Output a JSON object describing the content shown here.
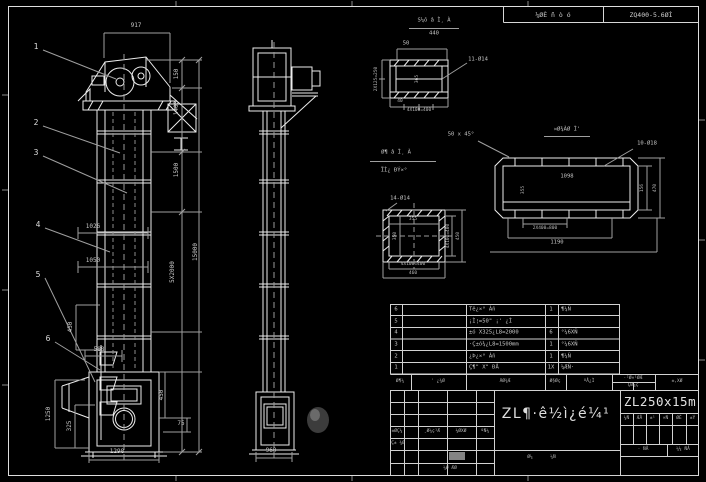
{
  "drawing": {
    "header_strip": {
      "material_label": "¼ØÈ ñ ò ó",
      "model_label": "ZQ400-5.6ØÌ"
    },
    "balloons": [
      "1",
      "2",
      "3",
      "4",
      "5",
      "6"
    ],
    "front_view": {
      "dims": {
        "w917": "917",
        "h150": "150",
        "h1400": "1400",
        "h1500": "1500",
        "h5x2000": "5X2000",
        "h15000": "15000",
        "l1026": "1026",
        "l1050": "1050",
        "bucket450": "450",
        "l588": "588",
        "h1250": "1250",
        "h325": "325",
        "b450": "450",
        "b75": "75",
        "w1298": "1298"
      }
    },
    "side_view": {
      "dims": {
        "w960": "960"
      }
    },
    "detail_a": {
      "title": "Ѕ¼ô â Ì¸ À",
      "scale": "440",
      "d50": "50",
      "holes": "11-Ø14",
      "left": "2X125=250",
      "d40": "40",
      "bottom": "4X100=400",
      "mid": "365"
    },
    "detail_b": {
      "title1": "Ø¶ â Ì¸ À",
      "title2": "ÏÌ¿ ÐÝ×°",
      "holes": "14-Ø14",
      "inner_w": "355",
      "inner_h": "350",
      "right_in": "4X100=400",
      "right_out": "450",
      "bottom_in": "4X100=400",
      "bottom_out": "460"
    },
    "detail_c": {
      "title": "¤Ø¾ÀØ Ì'",
      "chamfer": "50 x 45°",
      "holes": "10-Ø18",
      "inner_w": "1098",
      "inner_h": "355",
      "right_in": "156",
      "right_out": "470",
      "bottom_in": "2X400=800",
      "bottom_mid": "1190"
    },
    "bom": {
      "header": {
        "c1": "Ø¶¼",
        "c2": "' ¿¾Ø",
        "c3": "ÃØ¾Æ",
        "c4": "Ø§Øç",
        "c5": "ºÅ¿Ì",
        "c6a": "·²Ø×¹ØÆ",
        "c6b": "ÇØ¼ç",
        "c7": "±,XØ"
      },
      "rows": [
        {
          "no": "6",
          "name": "Tê¿×° Àñ",
          "qty": "1",
          "mat": "¶¼Ñ"
        },
        {
          "no": "5",
          "name": "¡Ì¦=50\" ¡' ¿Ì",
          "qty": "",
          "mat": ""
        },
        {
          "no": "4",
          "name": "±ó X325¿L8=2000",
          "qty": "6",
          "mat": "°¼6XÑ"
        },
        {
          "no": "3",
          "name": "·Ç±ó¾¿L8=1500mm",
          "qty": "1",
          "mat": "°¼6XÑ"
        },
        {
          "no": "2",
          "name": "¿Þ¿×° Àñ",
          "qty": "1",
          "mat": "¶¼Ñ"
        },
        {
          "no": "1",
          "name": "Ç¶\" X\" ÐÅ",
          "qty": "1X",
          "mat": "¼ÆÑ·"
        }
      ]
    },
    "titleblock": {
      "product_title": "ZL¶·ê½ì¿é¼¹",
      "model": "ZL250x15m",
      "sign_rows": {
        "r1c1": "±ØÇ¼",
        "r1c2": "¸Ø¼ç¹Æ",
        "r1c3": "¼ØXØ",
        "r1c4": "ºÑ¼",
        "r2c1": "Ç± ¾Ø",
        "r3c1": "¼Ø ÆØ"
      },
      "mini_row": [
        "¼Ñ",
        "ÆÅ",
        "±¹",
        "×Ñ",
        "ØÈ",
        "±Ý"
      ],
      "stage_label": "· ÑÅ",
      "scale_label": "¼¼ ÑÅ",
      "sheet1": "Ø¼",
      "sheet2": "¼Ñ"
    }
  }
}
